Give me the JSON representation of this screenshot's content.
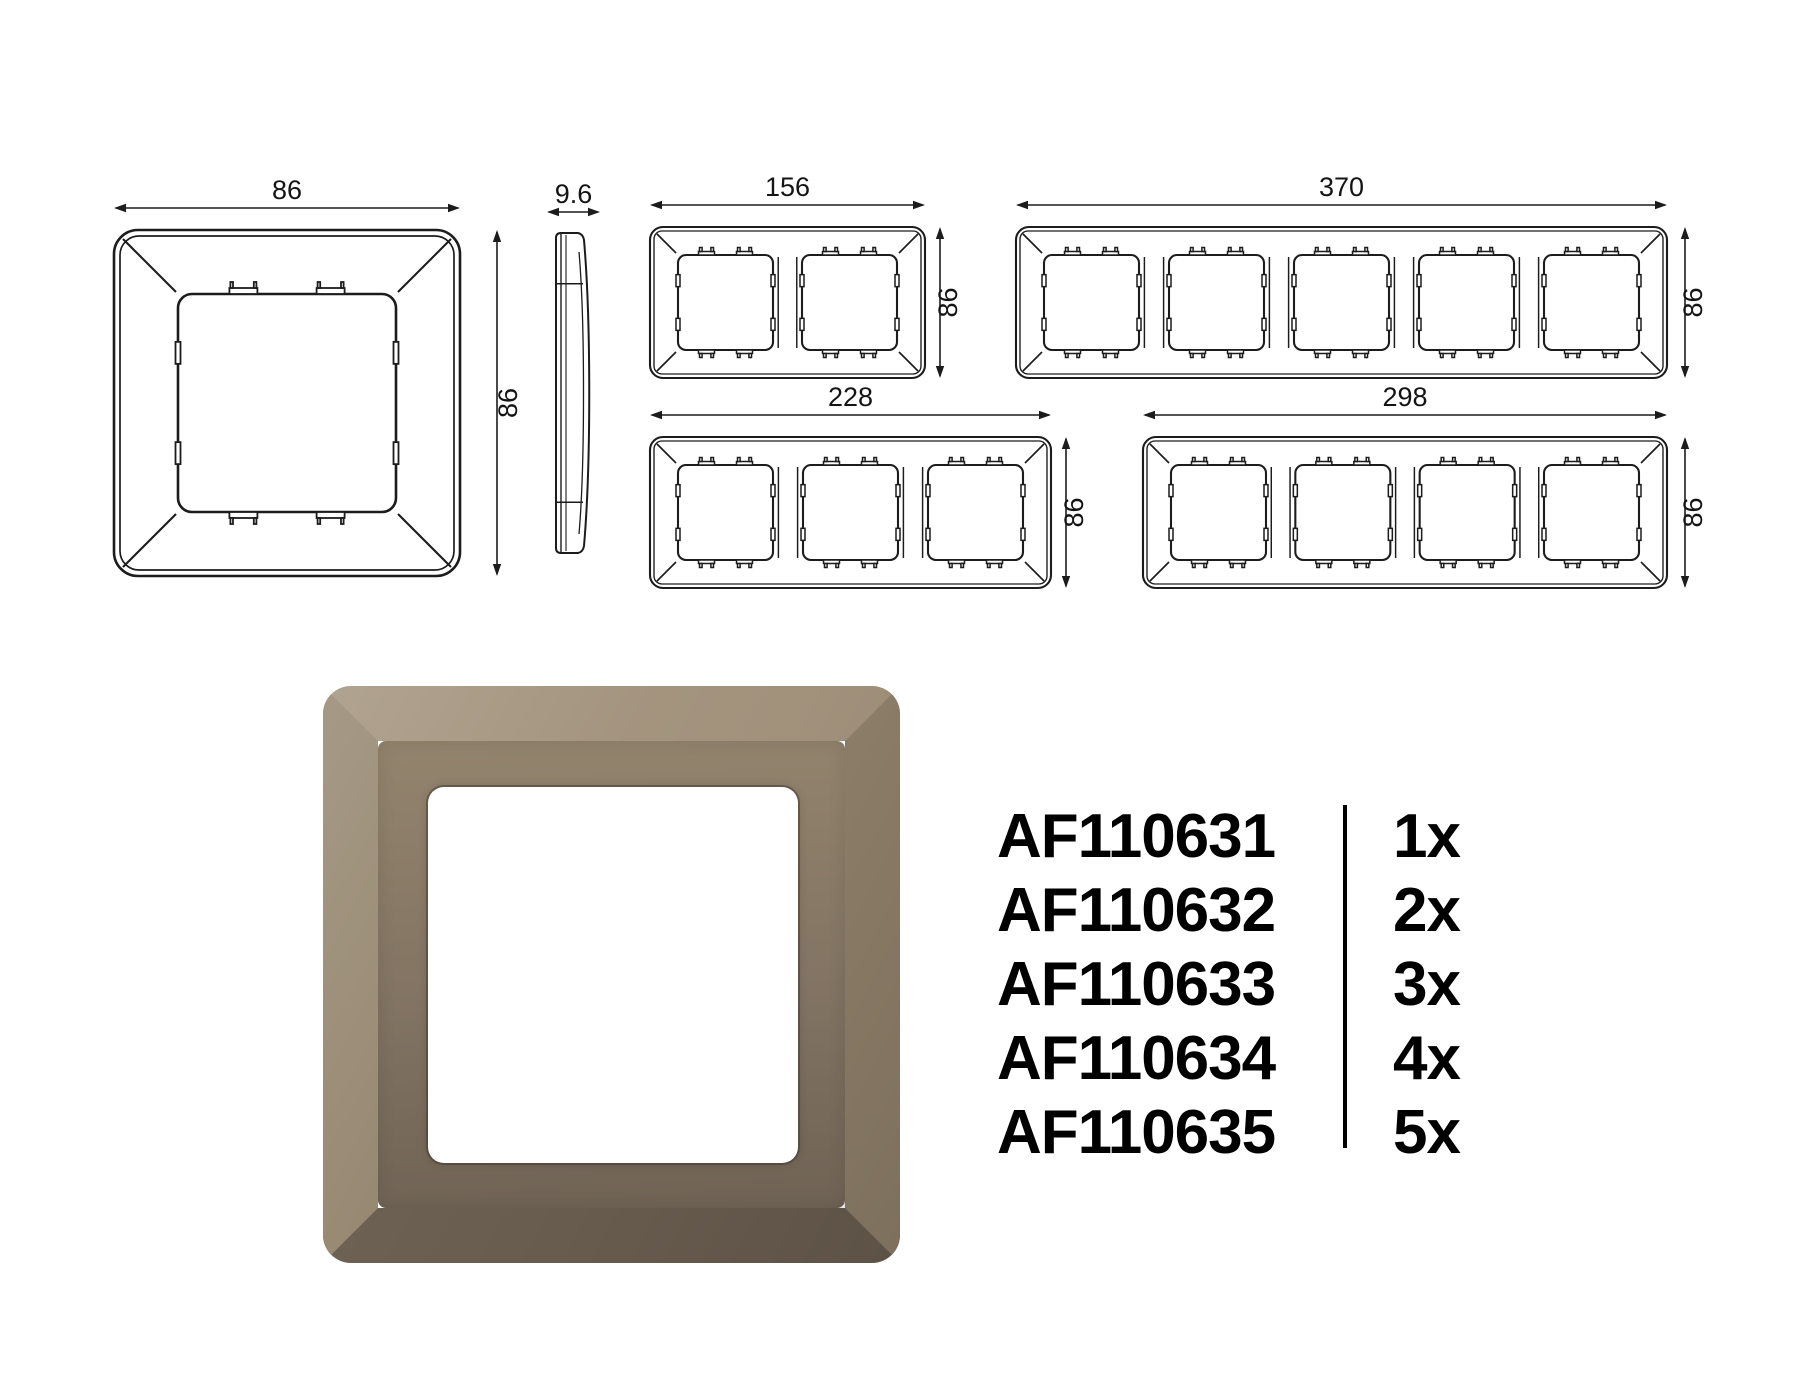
{
  "page": {
    "background": "#ffffff",
    "line_color": "#1c1c1c",
    "text_color": "#000000"
  },
  "views": [
    {
      "id": "front-1",
      "type": "front",
      "gangs": 1,
      "width_label": "86",
      "height_label": "86"
    },
    {
      "id": "side",
      "type": "side",
      "gangs": 1,
      "width_label": "9.6",
      "height_label": ""
    },
    {
      "id": "front-2",
      "type": "front",
      "gangs": 2,
      "width_label": "156",
      "height_label": "86"
    },
    {
      "id": "front-5",
      "type": "front",
      "gangs": 5,
      "width_label": "370",
      "height_label": "86"
    },
    {
      "id": "front-3",
      "type": "front",
      "gangs": 3,
      "width_label": "228",
      "height_label": "86"
    },
    {
      "id": "front-4",
      "type": "front",
      "gangs": 4,
      "width_label": "298",
      "height_label": "86"
    }
  ],
  "product_render": {
    "bevel_top": "#a2927c",
    "bevel_right": "#8e7f69",
    "bevel_bottom": "#695d4f",
    "bevel_left": "#95866f",
    "face_light": "#93846d",
    "face_dark": "#6f6355",
    "opening_color": "#ffffff"
  },
  "parts": [
    {
      "sku": "AF110631",
      "qty": "1x"
    },
    {
      "sku": "AF110632",
      "qty": "2x"
    },
    {
      "sku": "AF110633",
      "qty": "3x"
    },
    {
      "sku": "AF110634",
      "qty": "4x"
    },
    {
      "sku": "AF110635",
      "qty": "5x"
    }
  ]
}
